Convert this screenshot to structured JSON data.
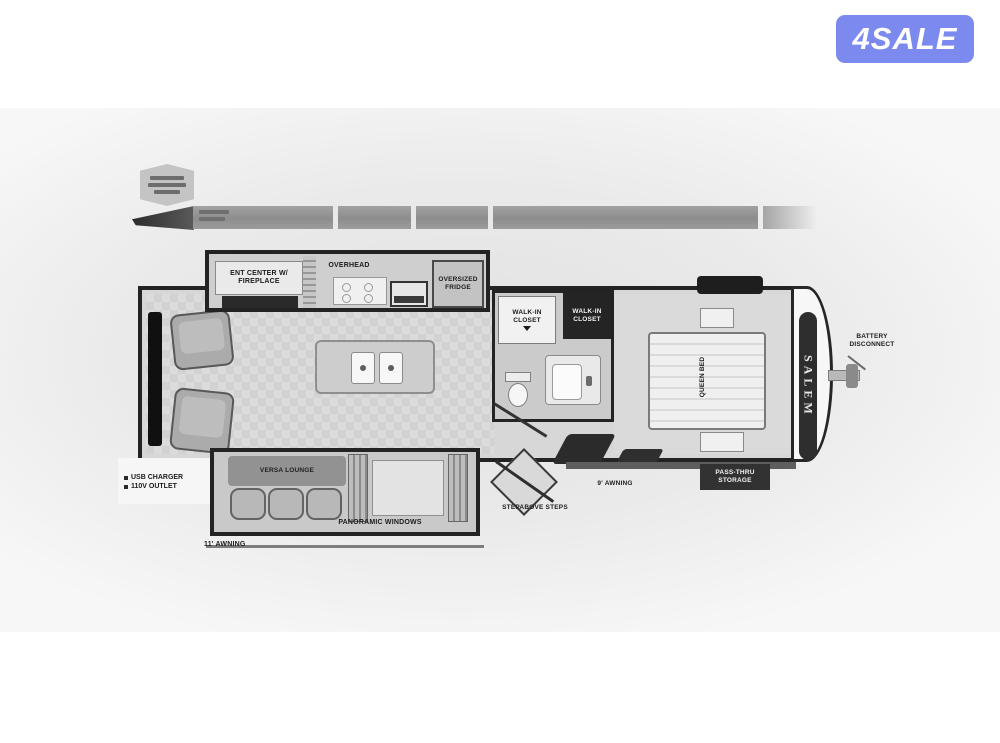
{
  "watermark": {
    "label": "4SALE",
    "bg_color": "#7c8af0",
    "text_color": "#ffffff"
  },
  "plan": {
    "galley": {
      "ent_center_label": "ENT CENTER W/ FIREPLACE",
      "overhead_label": "OVERHEAD",
      "fridge_label": "OVERSIZED FRIDGE"
    },
    "bath": {
      "closet_left_label": "WALK-IN CLOSET",
      "closet_right_label": "WALK-IN CLOSET"
    },
    "bedroom": {
      "bed_label": "QUEEN BED",
      "brand_label": "SALEM"
    },
    "front": {
      "battery_label": "BATTERY DISCONNECT"
    },
    "rear": {
      "usb_label": "USB CHARGER",
      "outlet_label": "110V OUTLET"
    },
    "door_side": {
      "steps_label": "STEPABOVE STEPS",
      "awning9_label": "9' AWNING",
      "storage_label": "PASS-THRU STORAGE"
    },
    "slide": {
      "sofa_label": "VERSA LOUNGE",
      "windows_label": "PANORAMIC WINDOWS",
      "awning11_label": "11' AWNING"
    }
  }
}
